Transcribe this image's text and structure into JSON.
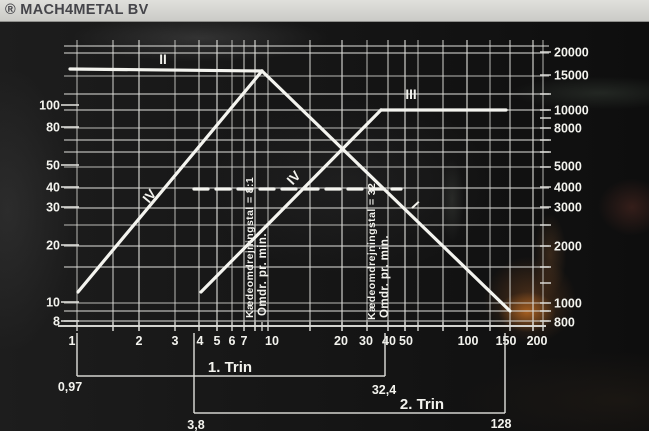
{
  "watermark": {
    "text": "® MACH4METAL BV"
  },
  "colors": {
    "grid": "#dededa",
    "series": "#f4f4ef",
    "text": "#f3f3ee",
    "watermark_bg": "#d7d7d3",
    "watermark_text": "#45454a",
    "reflection_orange": "#cd7323"
  },
  "chart_data": {
    "type": "line",
    "title": "",
    "xlabel": "",
    "ylabel_left": "",
    "ylabel_right": "",
    "axes": {
      "x": {
        "scale": "log",
        "range": [
          1,
          200
        ]
      },
      "y_left": {
        "scale": "log",
        "range": [
          8,
          200
        ]
      },
      "y_right": {
        "scale": "log",
        "range": [
          800,
          20000
        ]
      }
    },
    "grid": {
      "x_px": [
        77,
        113,
        139,
        175,
        199,
        217,
        232,
        244,
        255,
        268,
        310,
        342,
        367,
        388,
        405,
        418,
        443,
        467,
        490,
        510,
        533,
        543
      ],
      "y_px": [
        46,
        53,
        76,
        94,
        110,
        128,
        140,
        152,
        167,
        188,
        208,
        225,
        246,
        267,
        303,
        311,
        321
      ],
      "axis_y_px": 326,
      "plot_top_px": 40,
      "plot_bottom_px": 331
    },
    "ticks": {
      "left_y_px": [
        105,
        127,
        165,
        187,
        207,
        245,
        302,
        321
      ],
      "right_y_px": [
        52,
        75,
        94,
        110,
        118,
        128,
        140,
        152,
        167,
        187,
        207,
        225,
        246,
        267,
        283,
        303,
        311,
        321
      ],
      "bottom_extra_x_px": [
        262
      ]
    },
    "x_tick_labels": [
      {
        "t": "1",
        "x": 72
      },
      {
        "t": "2",
        "x": 139
      },
      {
        "t": "3",
        "x": 175
      },
      {
        "t": "4",
        "x": 200
      },
      {
        "t": "5",
        "x": 217
      },
      {
        "t": "6",
        "x": 232
      },
      {
        "t": "7",
        "x": 244
      },
      {
        "t": "10",
        "x": 272
      },
      {
        "t": "20",
        "x": 341
      },
      {
        "t": "30",
        "x": 366
      },
      {
        "t": "40",
        "x": 389
      },
      {
        "t": "50",
        "x": 406
      },
      {
        "t": "100",
        "x": 468
      },
      {
        "t": "150",
        "x": 506
      },
      {
        "t": "200",
        "x": 537
      }
    ],
    "x_tick_label_y": 345,
    "y_left_labels": [
      {
        "t": "100",
        "y": 105
      },
      {
        "t": "80",
        "y": 127
      },
      {
        "t": "50",
        "y": 165
      },
      {
        "t": "40",
        "y": 187
      },
      {
        "t": "30",
        "y": 207
      },
      {
        "t": "20",
        "y": 245
      },
      {
        "t": "10",
        "y": 302
      },
      {
        "t": "8",
        "y": 321
      }
    ],
    "y_right_labels": [
      {
        "t": "20000",
        "y": 52
      },
      {
        "t": "15000",
        "y": 75
      },
      {
        "t": "10000",
        "y": 110
      },
      {
        "t": "8000",
        "y": 128
      },
      {
        "t": "5000",
        "y": 166
      },
      {
        "t": "4000",
        "y": 187
      },
      {
        "t": "3000",
        "y": 207
      },
      {
        "t": "2000",
        "y": 246
      },
      {
        "t": "1000",
        "y": 303
      },
      {
        "t": "800",
        "y": 322
      }
    ],
    "series": [
      {
        "label": "II",
        "style": "solid",
        "px": [
          [
            70,
            69
          ],
          [
            262,
            71
          ]
        ],
        "values_left_scale": [
          [
            1,
            160
          ],
          [
            9.5,
            160
          ]
        ]
      },
      {
        "label": "I",
        "style": "solid",
        "px": [
          [
            262,
            71
          ],
          [
            510,
            311
          ]
        ],
        "values_left_scale": [
          [
            9.5,
            160
          ],
          [
            190,
            9
          ]
        ]
      },
      {
        "label": "IV",
        "style": "solid",
        "px": [
          [
            78,
            292
          ],
          [
            262,
            71
          ]
        ],
        "values_left_scale": [
          [
            1,
            11
          ],
          [
            9.5,
            160
          ]
        ]
      },
      {
        "label": "IV",
        "style": "solid",
        "px": [
          [
            201,
            292
          ],
          [
            381,
            110
          ]
        ],
        "values_left_scale": [
          [
            4.5,
            11
          ],
          [
            40,
            95
          ]
        ]
      },
      {
        "label": "III",
        "style": "solid",
        "px": [
          [
            381,
            110
          ],
          [
            506,
            110
          ]
        ],
        "values_left_scale": [
          [
            40,
            95
          ],
          [
            180,
            95
          ]
        ]
      },
      {
        "label": "",
        "style": "dashed",
        "px": [
          [
            194,
            189
          ],
          [
            401,
            189
          ]
        ],
        "values_left_scale": [
          [
            4.2,
            40
          ],
          [
            50,
            40
          ]
        ]
      }
    ],
    "line_labels": [
      {
        "text": "II",
        "x": 163,
        "y": 64,
        "rotate": 0
      },
      {
        "text": "III",
        "x": 411,
        "y": 99,
        "rotate": 0
      },
      {
        "text": "IV",
        "x": 153,
        "y": 199,
        "rotate": -50
      },
      {
        "text": "IV",
        "x": 297,
        "y": 181,
        "rotate": -47
      },
      {
        "text": "I",
        "x": 412,
        "y": 208,
        "rotate": 47
      }
    ],
    "vertical_annotations": [
      {
        "text": "Kædeomdrejningstal = 8:1",
        "x": 253,
        "y": 318,
        "size": 10.5
      },
      {
        "text": "Omdr. pr. min.",
        "x": 266,
        "y": 316,
        "size": 11.5
      },
      {
        "text": "Kædeomdrejningstal = 32",
        "x": 375,
        "y": 320,
        "size": 10.5
      },
      {
        "text": "Omdr. pr. min.",
        "x": 388,
        "y": 318,
        "size": 11.5
      }
    ],
    "brackets": [
      {
        "label": "1. Trin",
        "label_x": 230,
        "label_y": 372,
        "x1": 77,
        "x2": 385,
        "line_y": 376,
        "top_y": 333,
        "left_value": "0,97",
        "left_value_x": 70,
        "left_value_y": 391,
        "right_value": "32,4",
        "right_value_x": 384,
        "right_value_y": 394
      },
      {
        "label": "2. Trin",
        "label_x": 422,
        "label_y": 409,
        "x1": 194,
        "x2": 505,
        "line_y": 413,
        "top_y": 333,
        "left_value": "3,8",
        "left_value_x": 196,
        "left_value_y": 429,
        "right_value": "128",
        "right_value_x": 501,
        "right_value_y": 428
      }
    ]
  }
}
